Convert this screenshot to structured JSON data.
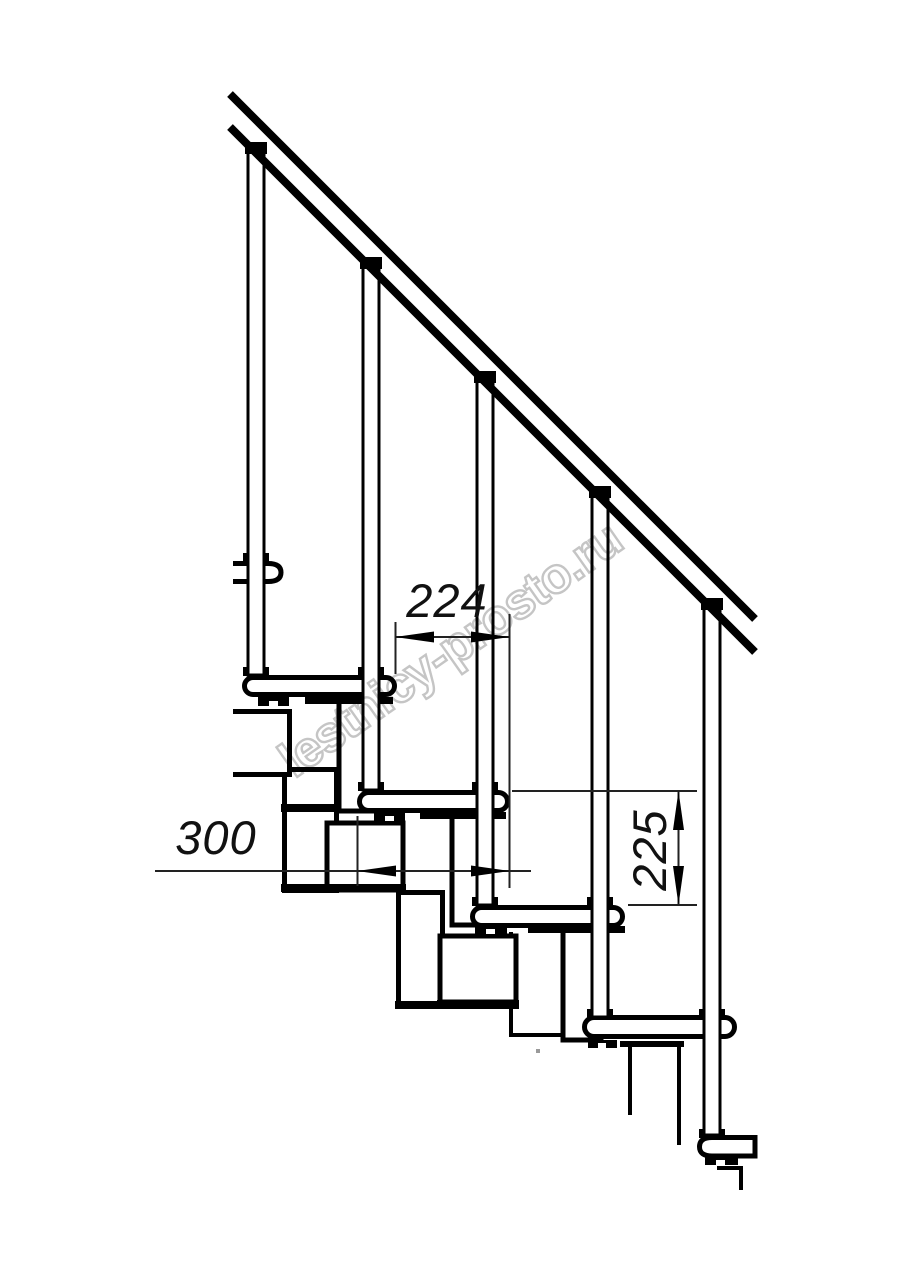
{
  "drawing": {
    "kind": "modular-staircase-elevation",
    "dimensions": {
      "run": {
        "value": "224",
        "orientation": "horizontal"
      },
      "depth": {
        "value": "300",
        "orientation": "horizontal"
      },
      "rise": {
        "value": "225",
        "orientation": "vertical"
      }
    },
    "watermark": {
      "text": "lestnicy-prosto.ru",
      "color": "#c5c5c5"
    },
    "colors": {
      "line": "#000000",
      "dimension_line": "#222222",
      "background": "#ffffff"
    }
  }
}
